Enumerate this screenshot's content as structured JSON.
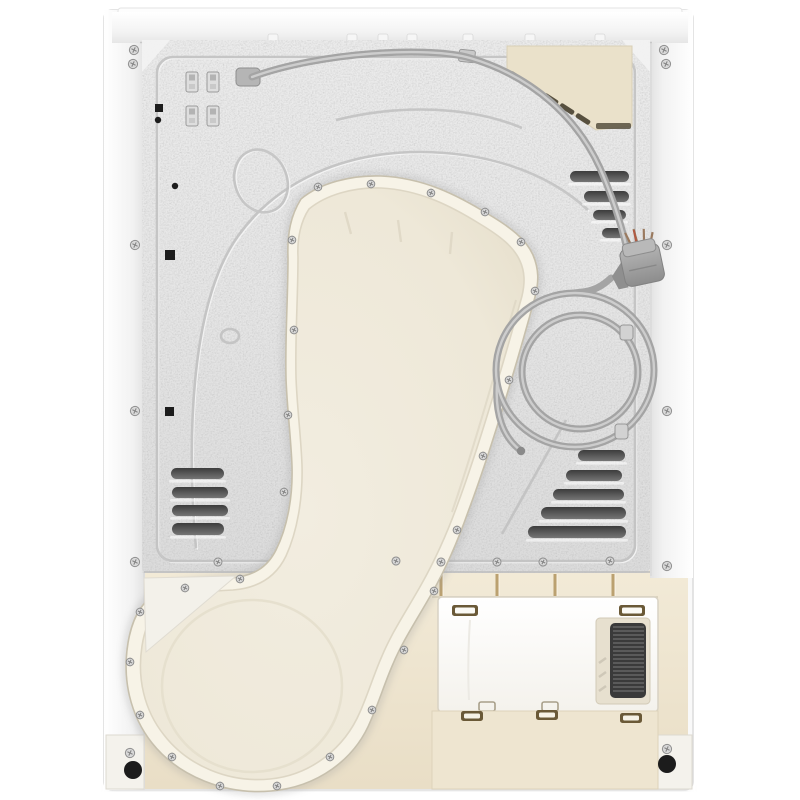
{
  "meta": {
    "description": "Rear view product photo of a white tumble dryer",
    "background": "#ffffff"
  },
  "palette": {
    "shell": "#f7f7f7",
    "metal": "#e4e4e4",
    "emboss": "#c0c0c0",
    "slot_dark": "#424242",
    "blank_plate": "#eae1ca",
    "duct_face": "#efe9da",
    "duct_rim": "#f7f3e7",
    "beige_lower": "#f1e9d6",
    "kick_panel": "#eee5d0",
    "access_panel": "#fcfcfb",
    "grille": "#3a3a3a",
    "cord": "#a4a4a4",
    "plug": "#9d9d9d",
    "screw": "#d9d9d9",
    "feet": "#1c1c1c",
    "divider": "#b1945e"
  },
  "figure": {
    "frame_screws": [
      [
        134,
        50
      ],
      [
        133,
        64
      ],
      [
        664,
        50
      ],
      [
        666,
        64
      ],
      [
        135,
        245
      ],
      [
        135,
        411
      ],
      [
        135,
        562
      ],
      [
        667,
        245
      ],
      [
        667,
        411
      ],
      [
        667,
        566
      ],
      [
        130,
        753
      ],
      [
        667,
        749
      ]
    ],
    "metal_bottom_screws": [
      [
        218,
        562
      ],
      [
        396,
        561
      ],
      [
        441,
        562
      ],
      [
        497,
        562
      ],
      [
        543,
        562
      ],
      [
        610,
        561
      ]
    ],
    "duct_rim_screws": [
      [
        318,
        187
      ],
      [
        371,
        184
      ],
      [
        431,
        193
      ],
      [
        485,
        212
      ],
      [
        521,
        242
      ],
      [
        535,
        291
      ],
      [
        509,
        380
      ],
      [
        483,
        456
      ],
      [
        457,
        530
      ],
      [
        434,
        591
      ],
      [
        404,
        650
      ],
      [
        372,
        710
      ],
      [
        330,
        757
      ],
      [
        277,
        786
      ],
      [
        220,
        786
      ],
      [
        172,
        757
      ],
      [
        140,
        715
      ],
      [
        130,
        662
      ],
      [
        140,
        612
      ],
      [
        185,
        588
      ],
      [
        240,
        579
      ],
      [
        292,
        240
      ],
      [
        294,
        330
      ],
      [
        288,
        415
      ],
      [
        284,
        492
      ]
    ],
    "left_vents": [
      [
        171,
        468,
        53,
        11
      ],
      [
        172,
        487,
        56,
        11
      ],
      [
        172,
        505,
        56,
        11
      ],
      [
        172,
        523,
        52,
        12
      ]
    ],
    "top_right_vents": [
      [
        570,
        171,
        59,
        11
      ],
      [
        584,
        191,
        45,
        11
      ],
      [
        593,
        210,
        33,
        10
      ],
      [
        602,
        228,
        24,
        10
      ]
    ],
    "right_vents": [
      [
        578,
        450,
        47,
        11
      ],
      [
        566,
        470,
        56,
        11
      ],
      [
        553,
        489,
        71,
        11
      ],
      [
        541,
        507,
        85,
        12
      ],
      [
        528,
        526,
        98,
        12
      ]
    ],
    "blank_slots": [
      [
        517,
        77
      ],
      [
        534,
        88
      ],
      [
        551,
        99
      ],
      [
        567,
        109
      ],
      [
        583,
        119
      ]
    ],
    "top_tabs": [
      273,
      352,
      383,
      412,
      468,
      530,
      600
    ],
    "strip_dividers": [
      441,
      497,
      555,
      613
    ],
    "metal_clips": [
      [
        186,
        72
      ],
      [
        207,
        72
      ],
      [
        186,
        106
      ],
      [
        207,
        106
      ]
    ],
    "black_squares": [
      [
        155,
        104,
        8
      ],
      [
        165,
        250,
        10
      ],
      [
        165,
        407,
        9
      ]
    ],
    "black_dots": [
      [
        158,
        120,
        3.2
      ],
      [
        175,
        186,
        3.2
      ]
    ],
    "cable_clips": [
      [
        620,
        325
      ],
      [
        615,
        424
      ]
    ],
    "panel_clips": [
      [
        452,
        605
      ],
      [
        619,
        605
      ]
    ],
    "panel_tabs": [
      [
        479,
        702
      ],
      [
        542,
        702
      ]
    ],
    "kick_clips": [
      [
        461,
        711
      ],
      [
        536,
        710
      ],
      [
        620,
        713
      ]
    ],
    "feet": [
      [
        133,
        770,
        9
      ],
      [
        667,
        764,
        9
      ]
    ],
    "grille": {
      "x1": 613,
      "x2": 644,
      "y1": 627,
      "y2": 694,
      "step": 4
    }
  }
}
